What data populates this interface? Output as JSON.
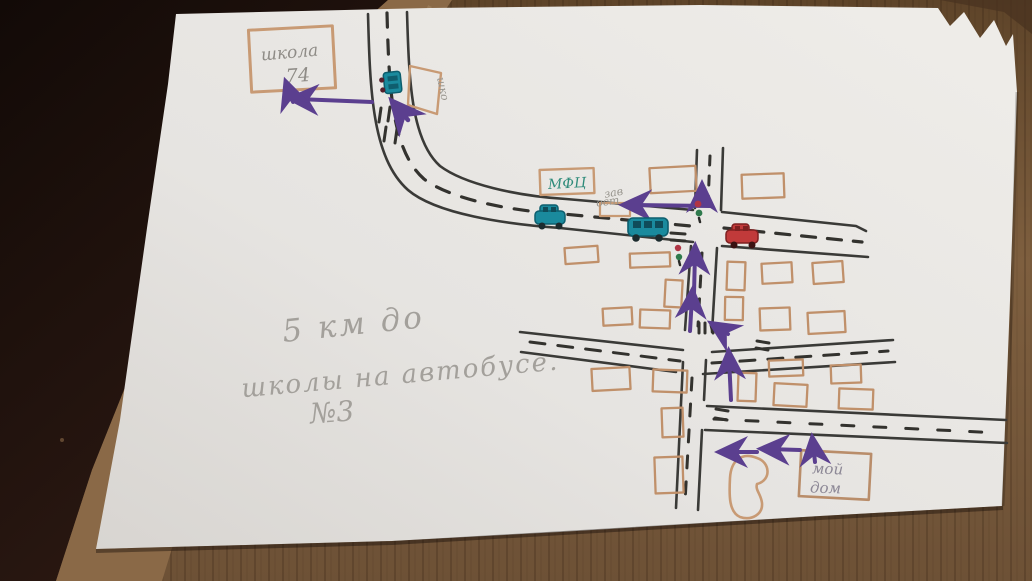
{
  "map": {
    "school": {
      "line1": "школа",
      "line2": "74"
    },
    "school_stop_label": "шко",
    "mfc_label": "МФЦ",
    "bus_stop": {
      "line1": "зав",
      "line2": "ост"
    },
    "note": {
      "line1": "5 км до",
      "line2": "школы на автобусе.",
      "line3": "№3"
    },
    "home": {
      "line1": "мой",
      "line2": "дом"
    }
  },
  "colors": {
    "paper": "#e9e7e4",
    "table_wood": "#7b5c3d",
    "table_dark": "#1a0f0b",
    "road_ink": "#3a3a37",
    "building_ink": "#c0906a",
    "route_purple": "#5b3f8f",
    "vehicle_teal": "#1a8a9d",
    "vehicle_red": "#c13a3a",
    "signal_red": "#b03545",
    "signal_green": "#2f7a4c",
    "pencil_gray": "#a3a09b",
    "mfc_green": "#2e8b7a"
  }
}
